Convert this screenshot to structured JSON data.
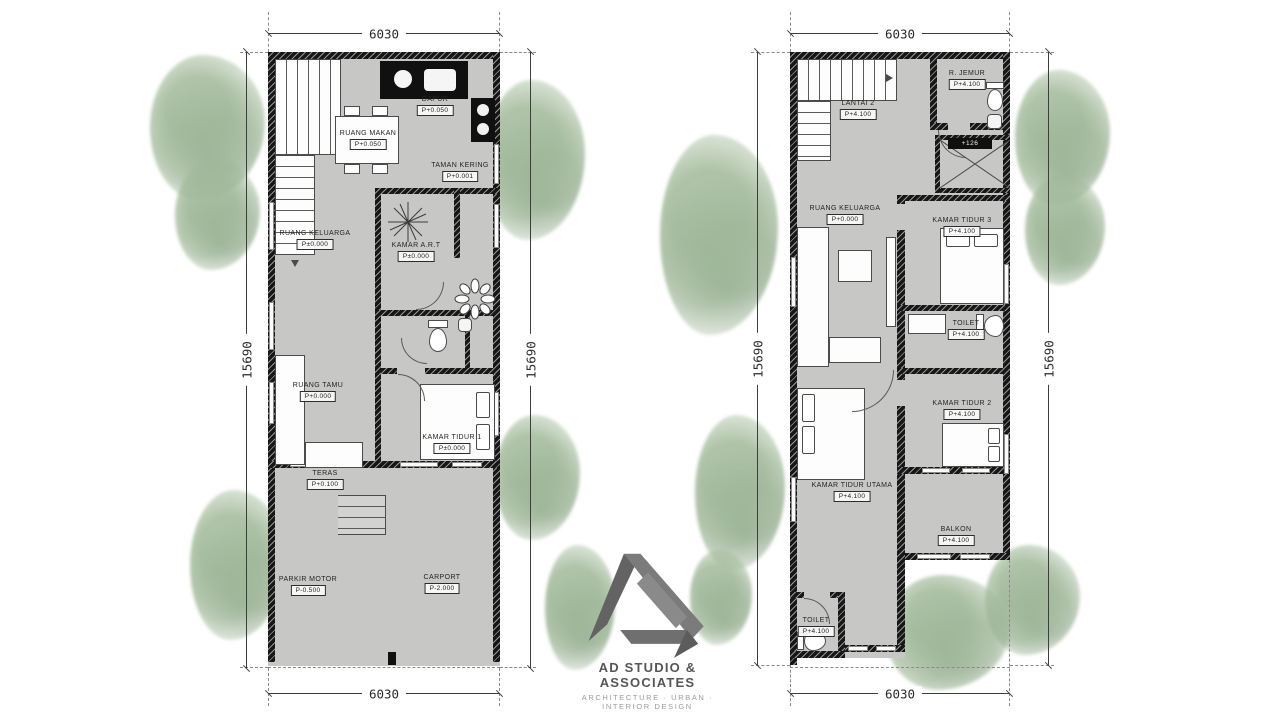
{
  "colors": {
    "floor": "#c7c8c5",
    "wall": "#171717",
    "tree_green": "#a0b898",
    "logo_gray": "#6e6e6e",
    "line": "#3d3d3d"
  },
  "brand": {
    "studio_name": "AD STUDIO & ASSOCIATES",
    "tagline": "ARCHITECTURE · URBAN · INTERIOR DESIGN"
  },
  "plans": [
    {
      "id": "ground-floor",
      "dims": {
        "top": "6030",
        "bottom": "6030",
        "left": "15690",
        "right": "15690"
      },
      "rooms": [
        {
          "name": "DAPUR",
          "elev": "P+0.050"
        },
        {
          "name": "RUANG MAKAN",
          "elev": "P+0.050"
        },
        {
          "name": "TAMAN KERING",
          "elev": "P+0.001"
        },
        {
          "name": "RUANG KELUARGA",
          "elev": "P±0.000"
        },
        {
          "name": "KAMAR A.R.T",
          "elev": "P±0.000"
        },
        {
          "name": "RUANG TAMU",
          "elev": "P+0.000"
        },
        {
          "name": "KAMAR TIDUR 1",
          "elev": "P±0.000"
        },
        {
          "name": "TERAS",
          "elev": "P+0.100"
        },
        {
          "name": "PARKIR MOTOR",
          "elev": "P-0.500"
        },
        {
          "name": "CARPORT",
          "elev": "P-2.000"
        }
      ]
    },
    {
      "id": "upper-floor",
      "dims": {
        "top": "6030",
        "bottom": "6030",
        "left": "15690",
        "right": "15690"
      },
      "void_marker": "+126",
      "rooms": [
        {
          "name": "LANTAI 2",
          "elev": "P+4.100"
        },
        {
          "name": "R. JEMUR",
          "elev": "P+4.100"
        },
        {
          "name": "RUANG KELUARGA",
          "elev": "P+0.000"
        },
        {
          "name": "KAMAR TIDUR 3",
          "elev": "P+4.100"
        },
        {
          "name": "TOILET",
          "elev": "P+4.100"
        },
        {
          "name": "KAMAR TIDUR 2",
          "elev": "P+4.100"
        },
        {
          "name": "KAMAR TIDUR UTAMA",
          "elev": "P+4.100"
        },
        {
          "name": "BALKON",
          "elev": "P+4.100"
        },
        {
          "name": "TOILET",
          "elev": "P+4.100"
        }
      ]
    }
  ]
}
